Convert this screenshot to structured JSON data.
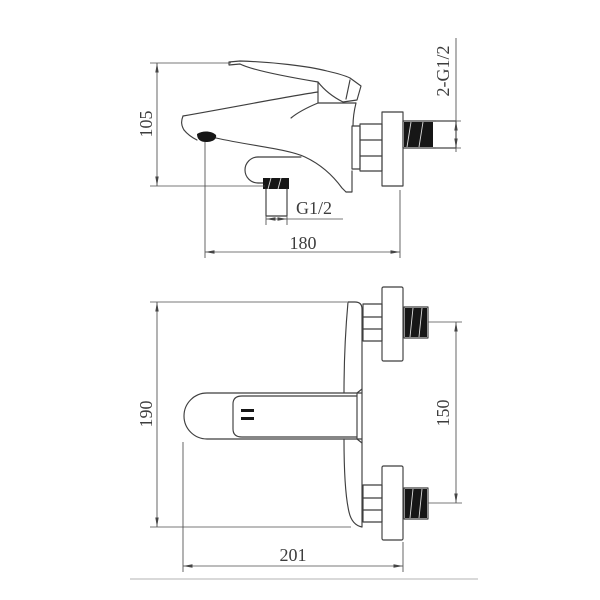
{
  "drawing": {
    "side_view": {
      "dim_height": "105",
      "dim_depth": "180",
      "label_outlet_thread": "G1/2",
      "label_inlet_thread": "2-G1/2"
    },
    "plan_view": {
      "dim_length": "190",
      "dim_inlet_centers": "150",
      "dim_depth": "201"
    }
  }
}
